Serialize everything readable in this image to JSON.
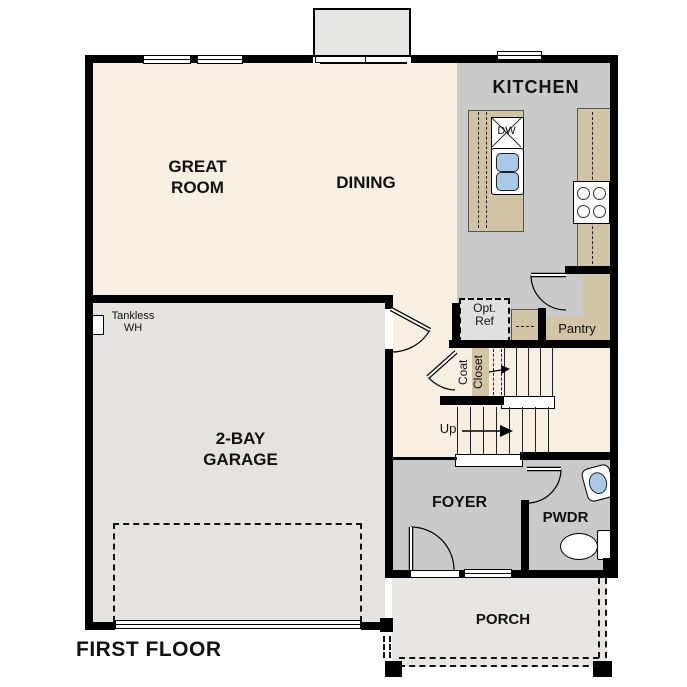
{
  "title": "FIRST FLOOR",
  "rooms": {
    "great_room": "GREAT\nROOM",
    "dining": "DINING",
    "kitchen": "KITCHEN",
    "garage": "2-BAY\nGARAGE",
    "foyer": "FOYER",
    "powder": "PWDR",
    "porch": "PORCH",
    "pantry": "Pantry"
  },
  "annotations": {
    "opt_ref": "Opt.\nRef",
    "coat": "Coat",
    "closet": "Closet",
    "up": "Up",
    "tankless_wh": "Tankless\nWH",
    "dishwasher": "DW"
  },
  "colors": {
    "floor_cream": "#f7efe2",
    "floor_gray": "#cacaca",
    "floor_garage": "#e4e3e0",
    "floor_porch": "#e7e6e3",
    "bump_gray": "#e5e5e3",
    "counter_tan": "#d2c5a6",
    "optref_fill": "#e0e0e0",
    "sink_blue": "#a9c9e9",
    "wall": "#000000"
  }
}
